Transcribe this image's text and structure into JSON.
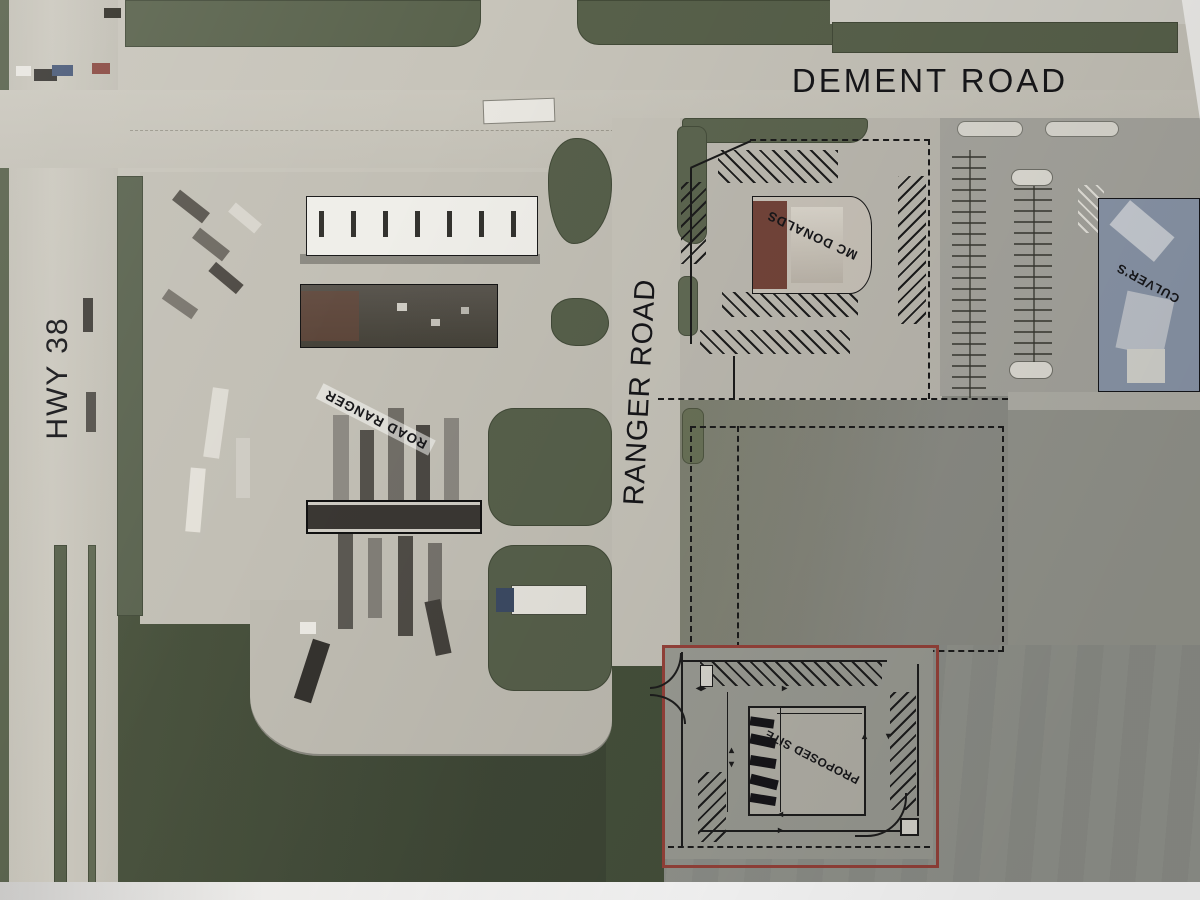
{
  "labels": {
    "dement_road": "DEMENT ROAD",
    "hwy_38": "HWY 38",
    "ranger_road": "RANGER ROAD",
    "mcdonalds": "MC DONALDS",
    "culvers": "CULVER'S",
    "road_ranger": "ROAD RANGER",
    "proposed_site": "PROPOSED SITE"
  },
  "colors": {
    "proposed_site_outline": "#96423a",
    "plan_linework": "#1d1d1d",
    "grass_dark": "#47503d",
    "pavement_light": "#c7c4ba",
    "culvers_roof": "#8d99ac",
    "mcdonalds_roof": "#74453a"
  }
}
